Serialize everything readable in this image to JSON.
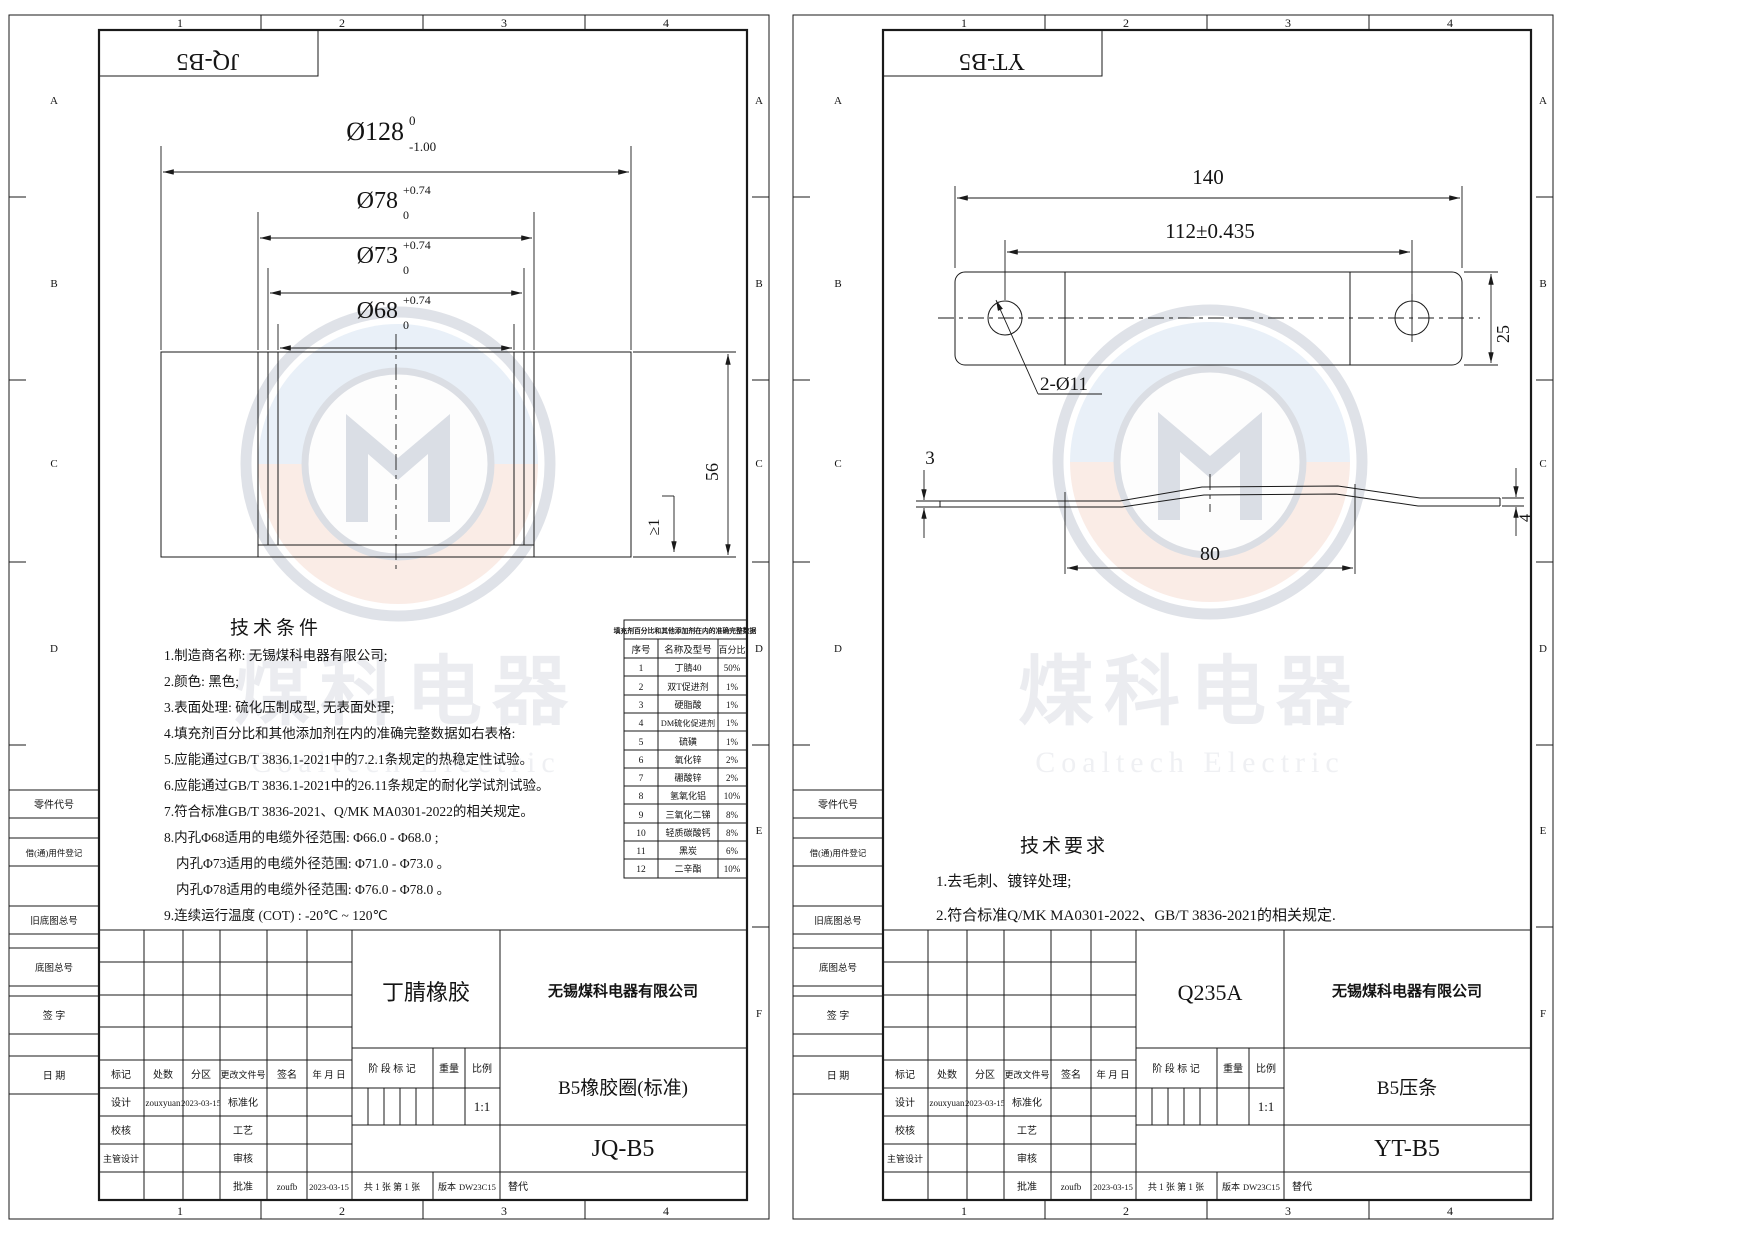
{
  "frame": {
    "cols": [
      "1",
      "2",
      "3",
      "4"
    ],
    "rows_left": [
      "A",
      "B",
      "C",
      "D"
    ],
    "rows_right": [
      "A",
      "B",
      "C",
      "D",
      "E",
      "F"
    ],
    "margin_boxes": {
      "part_no": "零件代号",
      "borrow": "借(通)用件登记",
      "old_master": "旧底图总号",
      "master": "底图总号",
      "sign": "签 字",
      "date": "日 期"
    }
  },
  "watermark": {
    "cn": "煤科电器",
    "en": "Coaltech Electric"
  },
  "tb_labels": {
    "mark": "标记",
    "count": "处数",
    "zone": "分区",
    "change_doc": "更改文件号",
    "sign": "签名",
    "date": "年 月 日",
    "design": "设计",
    "standard": "标准化",
    "check": "校核",
    "process": "工艺",
    "chief": "主管设计",
    "review": "审核",
    "approve": "批准",
    "stage": "阶 段 标 记",
    "weight": "重量",
    "scale": "比例",
    "pages": "共 1 张  第 1 张",
    "version": "版本",
    "replace": "替代"
  },
  "left": {
    "code": "JQ-B5",
    "dims": {
      "d1": {
        "v": "Ø128",
        "up": "0",
        "low": "-1.00"
      },
      "d2": {
        "v": "Ø78",
        "up": "+0.74",
        "low": "0"
      },
      "d3": {
        "v": "Ø73",
        "up": "+0.74",
        "low": "0"
      },
      "d4": {
        "v": "Ø68",
        "up": "+0.74",
        "low": "0"
      },
      "h": "56",
      "lip": "≥1"
    },
    "tech_title": "技术条件",
    "tech": [
      "1.制造商名称: 无锡煤科电器有限公司;",
      "2.颜色: 黑色;",
      "3.表面处理: 硫化压制成型, 无表面处理;",
      "4.填充剂百分比和其他添加剂在内的准确完整数据如右表格:",
      "5.应能通过GB/T 3836.1-2021中的7.2.1条规定的热稳定性试验。",
      "6.应能通过GB/T 3836.1-2021中的26.11条规定的耐化学试剂试验。",
      "7.符合标准GB/T 3836-2021、Q/MK MA0301-2022的相关规定。",
      "8.内孔Φ68适用的电缆外径范围: Φ66.0 - Φ68.0 ;",
      "内孔Φ73适用的电缆外径范围: Φ71.0 - Φ73.0 。",
      "内孔Φ78适用的电缆外径范围: Φ76.0 - Φ78.0 。",
      "9.连续运行温度 (COT) : -20℃ ~ 120℃"
    ],
    "table": {
      "title": "填充剂百分比和其他添加剂在内的准确完整数据",
      "headers": [
        "序号",
        "名称及型号",
        "百分比"
      ],
      "rows": [
        [
          "1",
          "丁腈40",
          "50%"
        ],
        [
          "2",
          "双T促进剂",
          "1%"
        ],
        [
          "3",
          "硬脂酸",
          "1%"
        ],
        [
          "4",
          "DM硫化促进剂",
          "1%"
        ],
        [
          "5",
          "硫磺",
          "1%"
        ],
        [
          "6",
          "氧化锌",
          "2%"
        ],
        [
          "7",
          "硼酸锌",
          "2%"
        ],
        [
          "8",
          "氢氧化铝",
          "10%"
        ],
        [
          "9",
          "三氧化二锑",
          "8%"
        ],
        [
          "10",
          "轻质碳酸钙",
          "8%"
        ],
        [
          "11",
          "黑炭",
          "6%"
        ],
        [
          "12",
          "二辛酯",
          "10%"
        ]
      ]
    },
    "tb": {
      "material": "丁腈橡胶",
      "company": "无锡煤科电器有限公司",
      "part": "B5橡胶圈(标准)",
      "code": "JQ-B5",
      "designer": "zouxyuan",
      "design_date": "2023-03-15",
      "approver": "zoufb",
      "approve_date": "2023-03-15",
      "scale": "1:1",
      "version": "DW23C15"
    }
  },
  "right": {
    "code": "YT-B5",
    "dims": {
      "len": "140",
      "centers": "112±0.435",
      "width": "25",
      "holes": "2-Ø11",
      "t_left": "3",
      "t_right": "4",
      "span": "80"
    },
    "tech_title": "技术要求",
    "tech": [
      "1.去毛刺、镀锌处理;",
      "2.符合标准Q/MK MA0301-2022、GB/T 3836-2021的相关规定."
    ],
    "tb": {
      "material": "Q235A",
      "company": "无锡煤科电器有限公司",
      "part": "B5压条",
      "code": "YT-B5",
      "designer": "zouxyuan",
      "design_date": "2023-03-15",
      "approver": "zoufb",
      "approve_date": "2023-03-15",
      "scale": "1:1",
      "version": "DW23C15"
    }
  }
}
